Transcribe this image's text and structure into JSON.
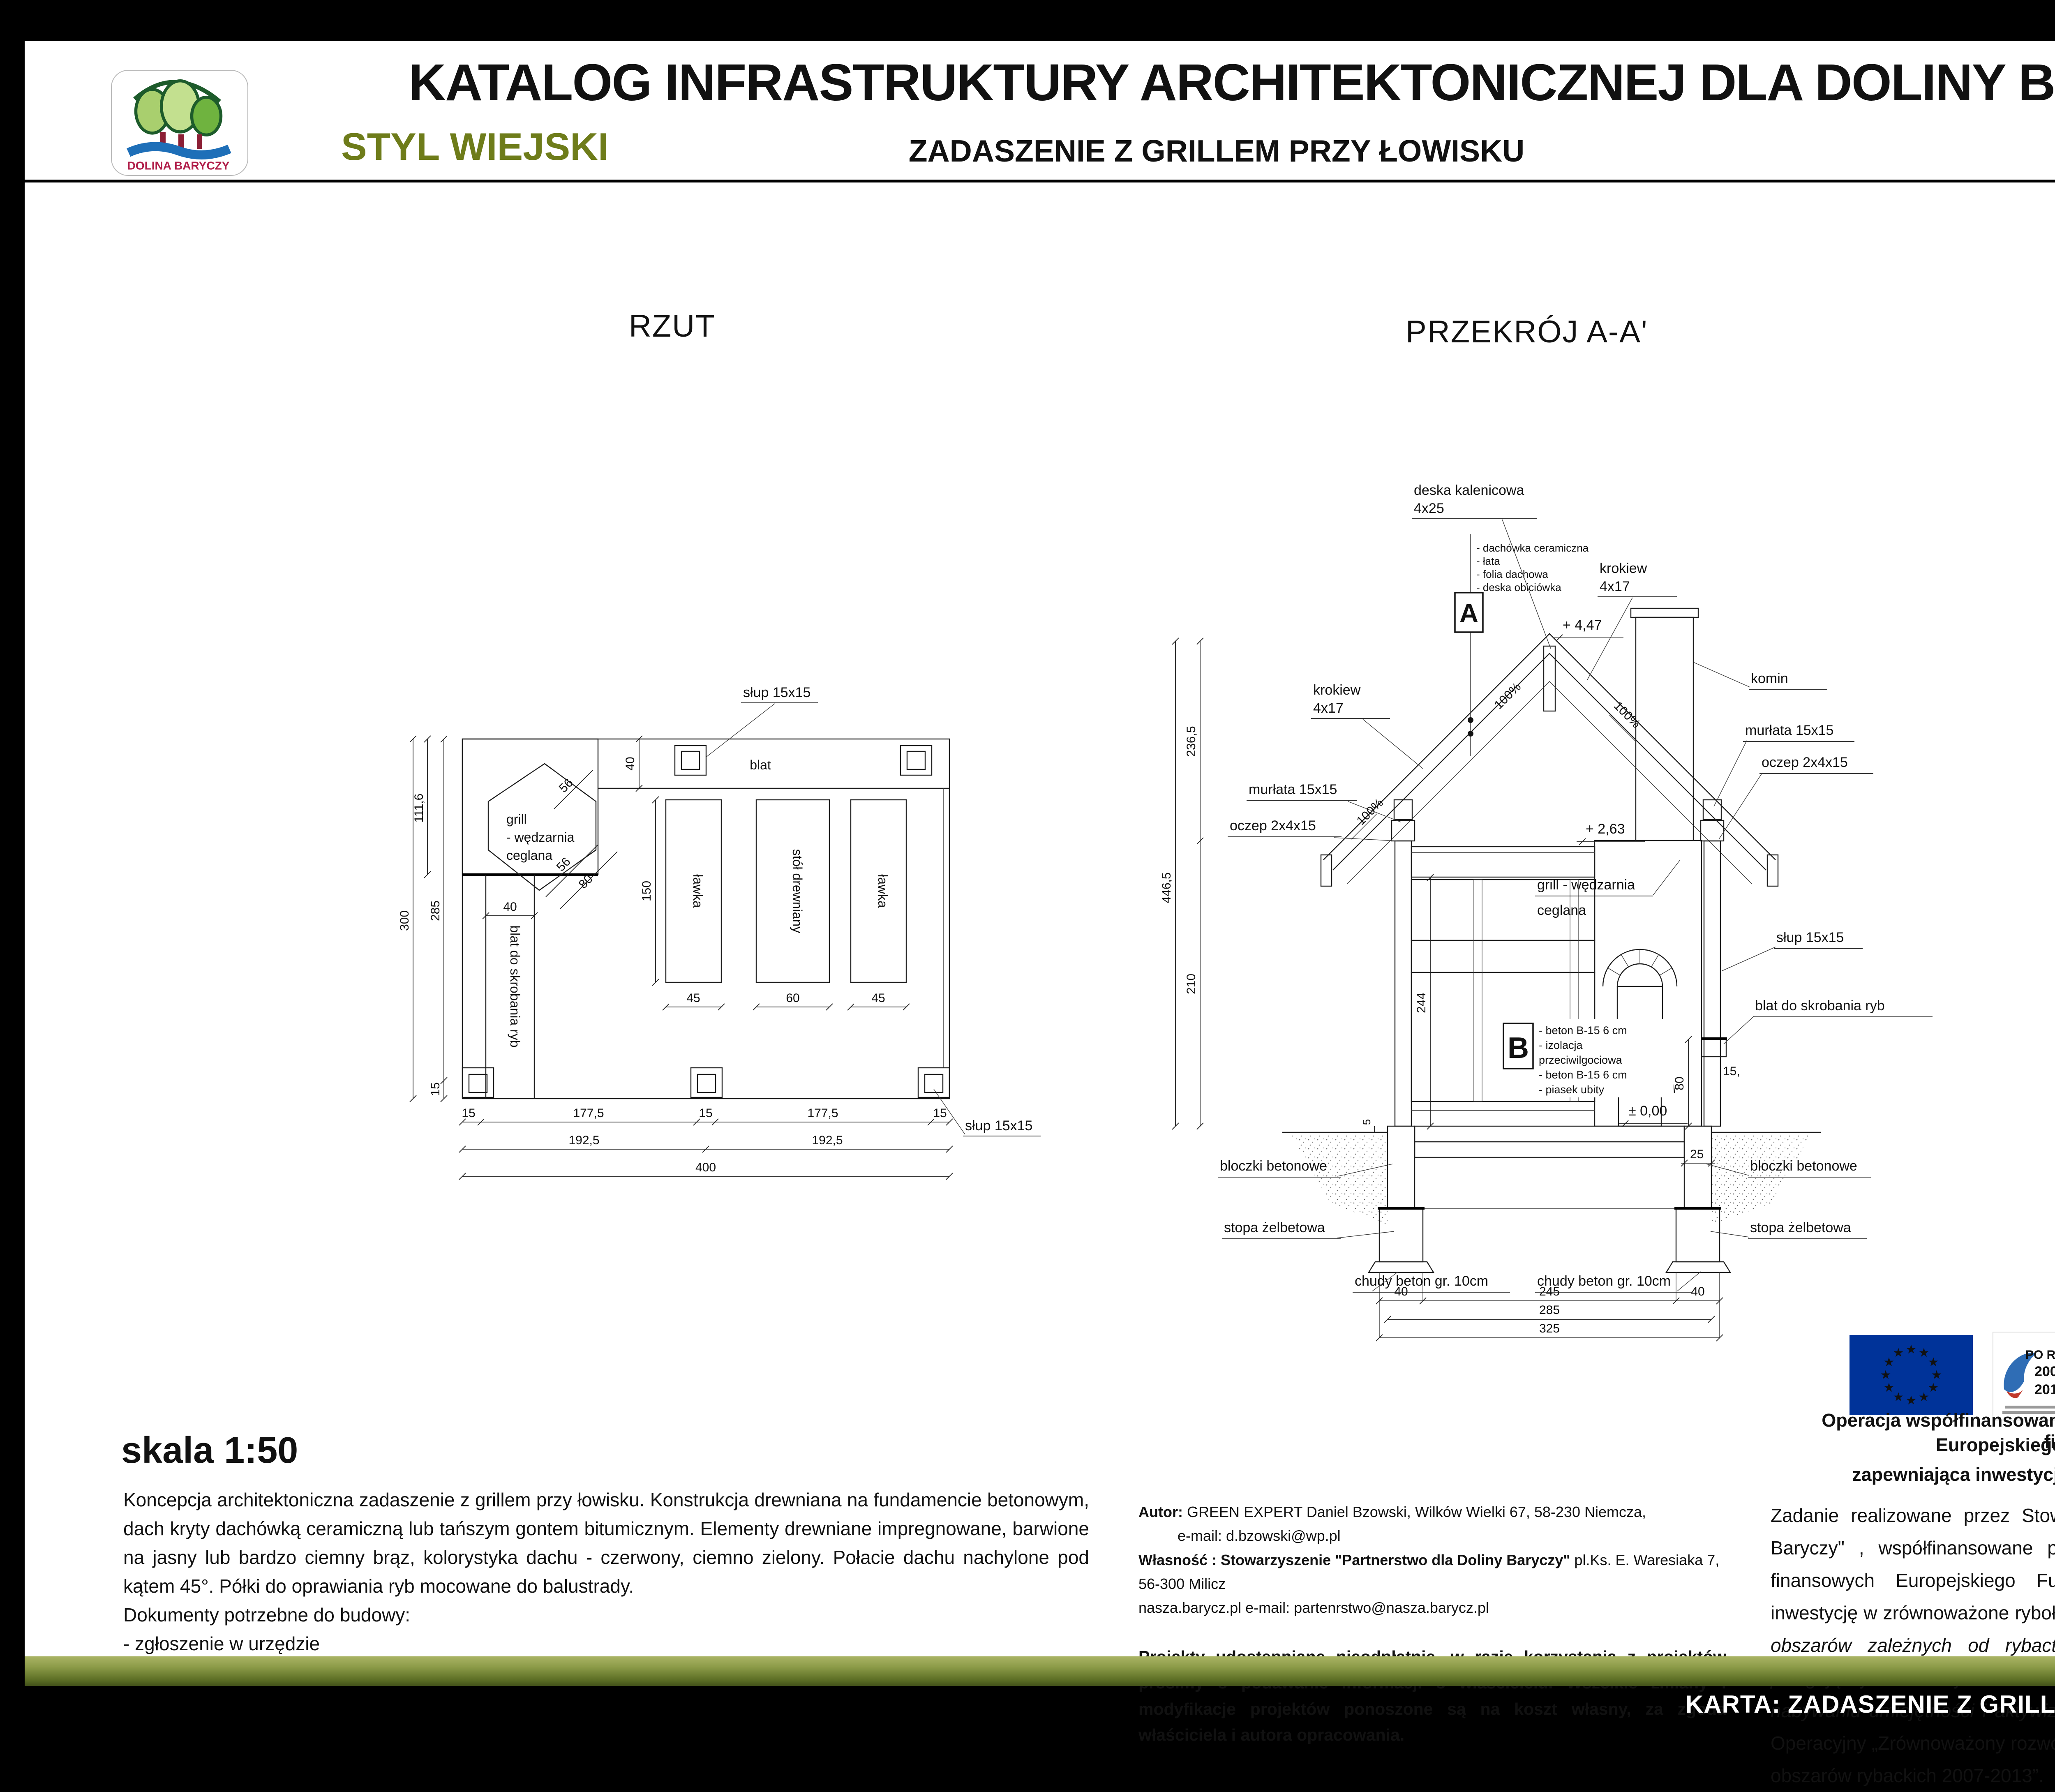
{
  "header": {
    "title": "KATALOG INFRASTRUKTURY ARCHITEKTONICZNEJ DLA DOLINY BARYCZY",
    "style_label": "STYL WIEJSKI",
    "subtitle": "ZADASZENIE Z GRILLEM PRZY ŁOWISKU",
    "logo_text": "DOLINA BARYCZY"
  },
  "plan": {
    "title": "RZUT",
    "labels": {
      "slup_top": "słup 15x15",
      "slup_bottom": "słup 15x15",
      "blat": "blat",
      "grill1": "grill",
      "grill2": "- wędzarnia",
      "grill3": "ceglana",
      "lawka": "ławka",
      "stol": "stół drewniany",
      "blat_ryby": "blat do skrobania ryb"
    },
    "dims": {
      "c300": "300",
      "c285": "285",
      "c111": "111,6",
      "c15": "15",
      "v40": "40",
      "h40": "40",
      "v150": "150",
      "d56a": "56",
      "d56b": "56",
      "d80": "80",
      "w45a": "45",
      "w60": "60",
      "w45b": "45",
      "r15a": "15",
      "r177a": "177,5",
      "r15b": "15",
      "r177b": "177,5",
      "r15c": "15",
      "r192a": "192,5",
      "r192b": "192,5",
      "r400": "400"
    }
  },
  "section": {
    "title": "PRZEKRÓJ A-A'",
    "labels": {
      "deska1": "deska kalenicowa",
      "deska2": "4x25",
      "krokiew": "krokiew",
      "krokiew_dim": "4x17",
      "komin": "komin",
      "murlata": "murłata 15x15",
      "oczep": "oczep 2x4x15",
      "slup": "słup 15x15",
      "blat_ryby": "blat do skrobania ryb",
      "grill1": "grill - wędzarnia",
      "grill2": "ceglana",
      "bloczki": "bloczki betonowe",
      "stopa": "stopa żelbetowa",
      "chudy": "chudy beton gr. 10cm",
      "slope": "100%"
    },
    "levels": {
      "top": "+ 4,47",
      "mid": "+ 2,63",
      "zero": "± 0,00"
    },
    "dims": {
      "h2365": "236,5",
      "h4465": "446,5",
      "h210": "210",
      "h244": "244",
      "h80": "80",
      "w15": "15,",
      "w5": "5",
      "w25": "25",
      "b40a": "40",
      "b245": "245",
      "b40b": "40",
      "b285": "285",
      "b325": "325"
    },
    "a_box": {
      "letter": "A",
      "items": [
        "- dachówka ceramiczna",
        "- łata",
        "- folia dachowa",
        "- deska obiciówka"
      ]
    },
    "b_box": {
      "letter": "B",
      "items": [
        "- beton B-15  6 cm",
        "- izolacja",
        "  przeciwilgociowa",
        "- beton B-15  6 cm",
        "- piasek ubity"
      ]
    }
  },
  "notes": {
    "scale_label": "skala 1:50",
    "description": "Koncepcja architektoniczna zadaszenie z grillem przy łowisku. Konstrukcja drewniana na fundamencie betonowym, dach kryty dachówką ceramiczną lub tańszym gontem bitumicznym. Elementy drewniane impregnowane, barwione na jasny lub bardzo ciemny brąz, kolorystyka dachu - czerwony, ciemno zielony.  Połacie dachu nachylone pod kątem 45°. Półki do oprawiania ryb mocowane do balustrady.",
    "docs_heading": "Dokumenty potrzebne do budowy:",
    "docs_item": "- zgłoszenie w urzędzie"
  },
  "credits": {
    "author_label": "Autor:",
    "author_rest": " GREEN EXPERT Daniel Bzowski, Wilków Wielki 67, 58-230 Niemcza,",
    "author_email": "e-mail: d.bzowski@wp.pl",
    "owner_label": "Własność : Stowarzyszenie \"Partnerstwo dla Doliny Baryczy\"",
    "owner_rest": "  pl.Ks. E. Waresiaka 7, 56-300 Milicz",
    "site_line": "nasza.barycz.pl   e-mail:   partenrstwo@nasza.barycz.pl",
    "disclaimer": "Projekty udostępniane nieodpłatnie, w razie korzystania z projektów prosimy o podawanie informacji o właścicielu. Wszelkie zmiany i modyfikacje projektów ponoszone są na koszt własny, za zgoda właściciela i autora opracowania."
  },
  "funding": {
    "logos": {
      "eu_star": "★",
      "po_ryby_name": "PO RYBY",
      "po_ryby_y1": "2007",
      "po_ryby_y2": "2013",
      "dolina": "DOLINA BARYCZY",
      "partner1": "PARTNERSTWO",
      "partner2": "DLA DOLINY BARYCZY"
    },
    "line1": "Operacja współfinansowana przez Unię Europejską ze środków finansowych",
    "line2": "Europejskiego Funduszu Rybackiego",
    "line3": "zapewniająca inwestycje w zrównoważone rybołówstwo.",
    "para_start": "Zadanie realizowane przez Stowarzyszenie „Partnerstwo dla Doliny Baryczy\" , współfinansowane przez Unię Europejską ze środków finansowych Europejskiego Funduszu Rybackiego zapewniającą inwestycję w zrównoważone rybołówstwo w ramach środka ",
    "para_italic": "4.1. Rozwój obszarów zależnych od rybactwa, w zakresie realizacji operacji polegającej na funkcjonowaniu lokalnej grupy rybackiej (LGR) oraz nabywaniu umiejętności i aktywizacji lokalnych społeczności.",
    "para_end": " Program Operacyjny „Zrównoważony rozwój sektora rybołówstwa i nadbrzeżnych obszarów rybackich 2007-2013”."
  },
  "footer": {
    "karta": "KARTA: ZADASZENIE Z GRILLEM PRZY ŁOWISKU 1/3"
  },
  "colors": {
    "accent_olive": "#6e7c1a",
    "footer_gradient_top": "#aab465",
    "footer_gradient_bottom": "#42511a",
    "dolina_red": "#b01d49",
    "eu_blue": "#003399",
    "eu_star_yellow": "#ffcc00",
    "po_ryby_blue": "#1c4f9e",
    "partner_green": "#2d6b2d"
  }
}
